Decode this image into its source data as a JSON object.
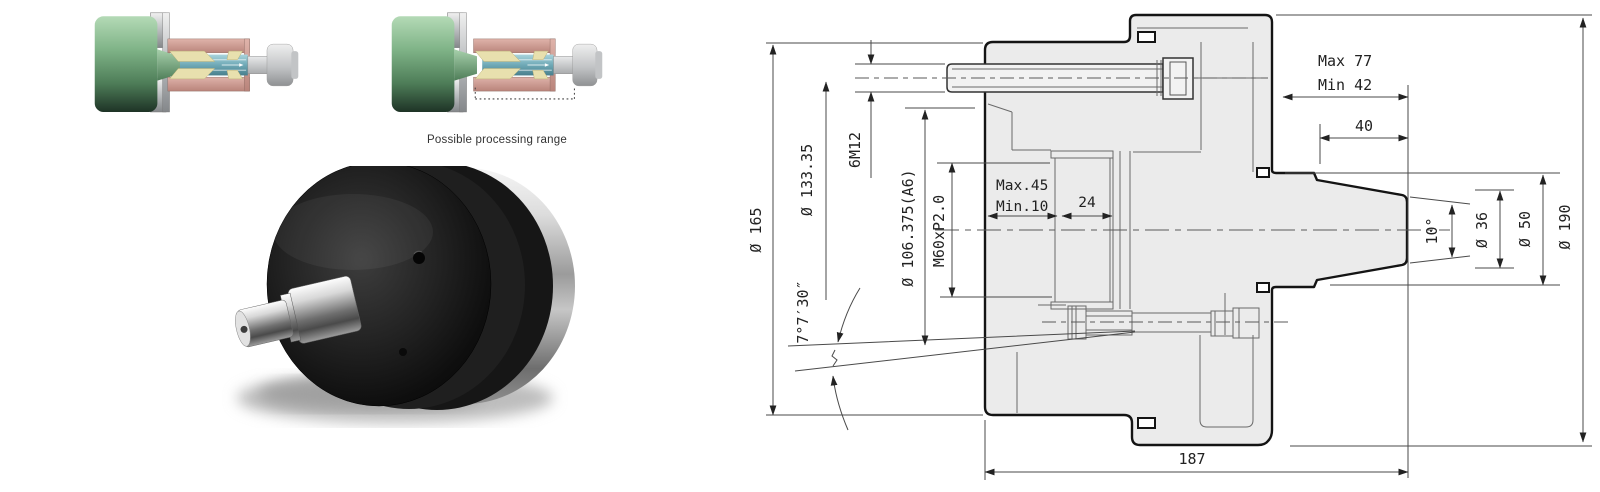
{
  "page": {
    "background": "#ffffff"
  },
  "renders": {
    "caption": "Possible processing range",
    "colors": {
      "body_green": "#6fa878",
      "sleeve_pink": "#cf9a90",
      "wedge_cream": "#e8e0ae",
      "core_teal": "#79b7c3",
      "bracket_silver": "#c9ccce"
    }
  },
  "drawing": {
    "labels": {
      "dia165": "Ø 165",
      "dia133": "Ø 133.35",
      "bolts": "6M12",
      "dia106": "Ø 106.375(A6)",
      "thread": "M60xP2.0",
      "angle7": "7°7′30″",
      "max45": "Max.45",
      "min10": "Min.10",
      "d24": "24",
      "max77": "Max 77",
      "min42": "Min 42",
      "d40": "40",
      "angle10": "10°",
      "dia36": "Ø 36",
      "dia50": "Ø 50",
      "dia190": "Ø 190",
      "d187": "187"
    }
  }
}
